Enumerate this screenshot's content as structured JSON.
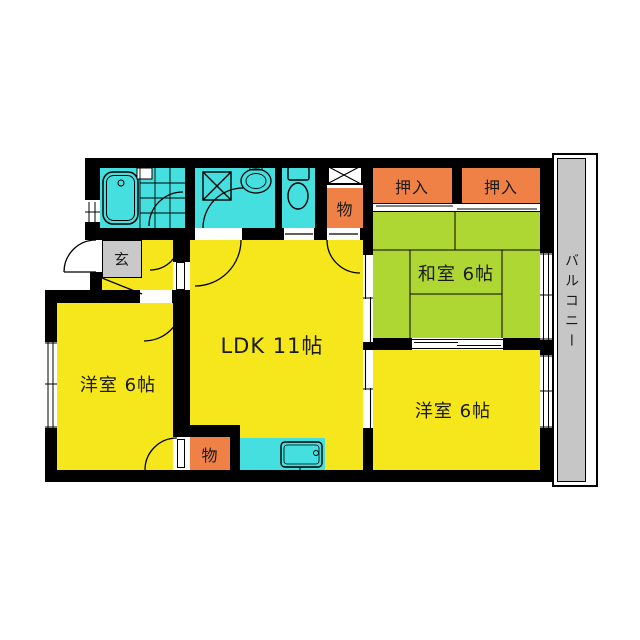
{
  "floor_plan": {
    "rooms": {
      "ldk": "LDK 11帖",
      "japanese_room": "和室 6帖",
      "western_room_left": "洋室 6帖",
      "western_room_right": "洋室 6帖"
    },
    "features": {
      "closet_left": "押入",
      "closet_right": "押入",
      "storage_top": "物",
      "storage_bottom": "物",
      "entrance": "玄",
      "balcony": "バルコニー"
    },
    "colors": {
      "room_yellow": "#F6E71D",
      "tatami_green": "#AFD733",
      "wet_area_cyan": "#45DFDF",
      "closet_orange": "#EF8147",
      "entrance_gray": "#C9C9C9",
      "balcony_gray": "#C6C6C6",
      "wall_black": "#000000"
    }
  }
}
